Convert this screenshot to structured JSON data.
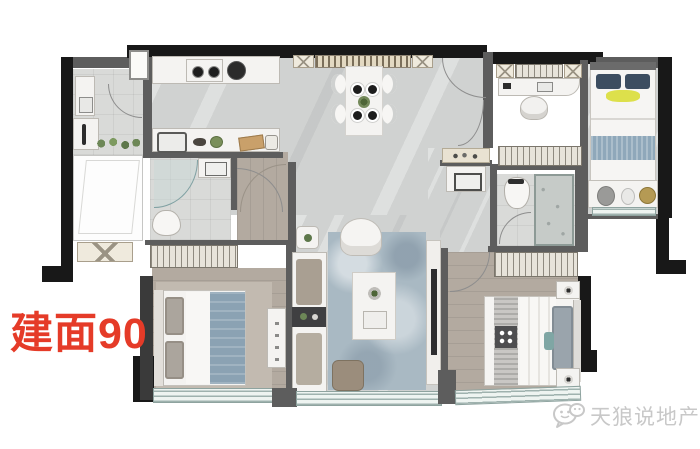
{
  "annotation": {
    "area_label": "建面90",
    "area_label_color": "#e53b28"
  },
  "watermark": {
    "text": "天狼说地产",
    "icon": "wechat-icon",
    "color": "#c8c8c8"
  },
  "floor_plan": {
    "type": "apartment-top-down-render",
    "gross_area_sqm": 90,
    "rooms": [
      {
        "name": "service-balcony-laundry",
        "furniture": [
          "utility-sink",
          "washing-machine",
          "plants",
          "flex-area",
          "equipment-box"
        ]
      },
      {
        "name": "kitchen",
        "furniture": [
          "cooktop-2-burner",
          "range-hood-pot",
          "counter",
          "kitchen-sink",
          "food-items",
          "window-to-balcony"
        ]
      },
      {
        "name": "dining-room",
        "furniture": [
          "sideboard-with-x-cabinets",
          "dining-table",
          "4-chairs",
          "4-place-settings",
          "center-plant",
          "entry-door"
        ]
      },
      {
        "name": "bathroom-1",
        "furniture": [
          "curved-glass-shower",
          "washbasin",
          "toilet",
          "door"
        ]
      },
      {
        "name": "hallway-wood",
        "furniture": [
          "master-door-arc"
        ]
      },
      {
        "name": "study",
        "furniture": [
          "x-cabinet",
          "desk",
          "chair",
          "wardrobe",
          "door"
        ]
      },
      {
        "name": "kids-bedroom",
        "furniture": [
          "bed-navy-pillows",
          "yellow-blanket",
          "blue-throw",
          "foot-bench-with-plush-toys",
          "window-sill"
        ]
      },
      {
        "name": "bathroom-2",
        "furniture": [
          "toilet",
          "textured-glass-shower",
          "outside-vanity-basin",
          "decor-shelf",
          "door"
        ]
      },
      {
        "name": "living-room",
        "furniture": [
          "armchair",
          "plant-side-table",
          "sofa",
          "dark-side-table",
          "blue-rug",
          "coffee-table",
          "ottoman",
          "tv-panel"
        ]
      },
      {
        "name": "master-bedroom",
        "furniture": [
          "slatted-wardrobe",
          "double-bed-blue-duvet",
          "headboard",
          "dresser",
          "floor-window"
        ]
      },
      {
        "name": "bedroom-2",
        "furniture": [
          "slatted-wardrobe",
          "double-bed-gray-runner",
          "nightstand-with-lamp-top",
          "nightstand-with-lamp-bottom",
          "teal-pillow",
          "floor-window"
        ]
      }
    ],
    "colors": {
      "exterior_wall": "#181818",
      "interior_wall": "#5d5d5d",
      "marble_floor": "#d0d2d1",
      "wood_floor": "#b3aaa0",
      "duvet_blue": "#8ba2b3",
      "kids_throw_blue": "#8fa8ba",
      "accent_yellow": "#dde04b",
      "rug_blue_gray": "#a9b9c3"
    }
  }
}
